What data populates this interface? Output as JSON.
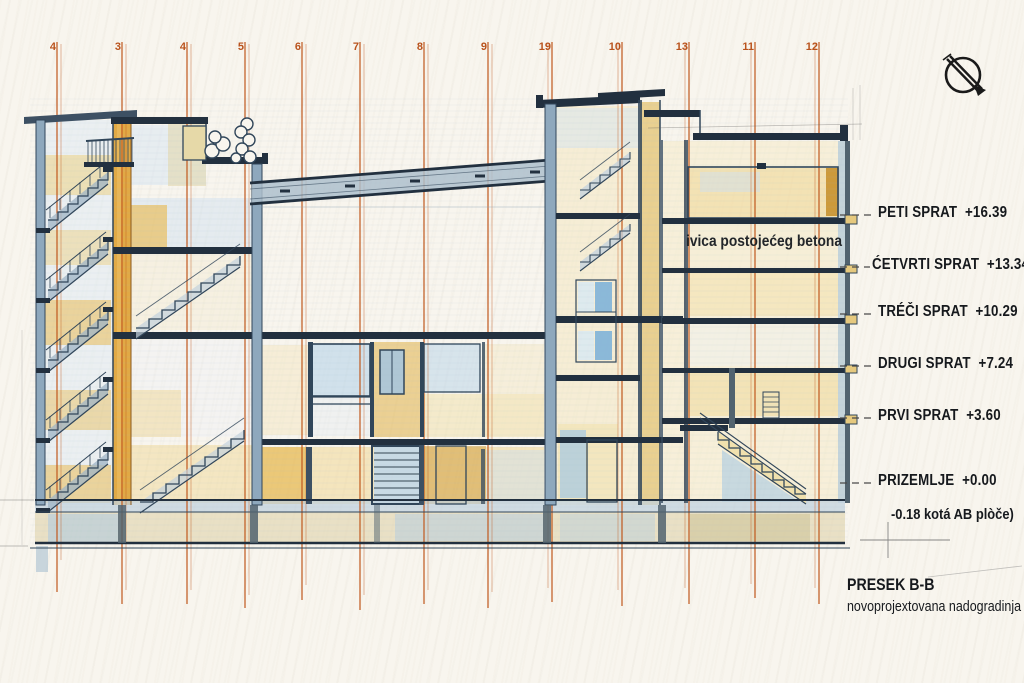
{
  "drawing": {
    "grid_labels": [
      "4",
      "3",
      "4",
      "5",
      "6",
      "7",
      "8",
      "9",
      "19",
      "10",
      "13",
      "11",
      "12"
    ],
    "levels": [
      {
        "name": "PETI SPRAT",
        "elevation": "+16.39"
      },
      {
        "name": "ĆETVRTI SPRAT",
        "elevation": "+13.34"
      },
      {
        "name": "TRÉČI SPRAT",
        "elevation": "+10.29"
      },
      {
        "name": "DRUGI SPRAT",
        "elevation": "+7.24"
      },
      {
        "name": "PRVI SPRAT",
        "elevation": "+3.60"
      },
      {
        "name": "PRIZEMLJE",
        "elevation": "+0.00"
      }
    ],
    "foundation_note": "-0.18 kotá AB plòče)",
    "annotation": "ivica postojećeg betona",
    "title_block": {
      "title": "PRESEK B-B",
      "subtitle": "novoprojextovana nadogradinja"
    },
    "colors": {
      "grid": "#c0571c",
      "ink": "#31465a",
      "ochre": "#dfa43b",
      "wash_yellow": "#f0d795",
      "wash_blue": "#b8cfe2",
      "text": "#16191d"
    }
  }
}
